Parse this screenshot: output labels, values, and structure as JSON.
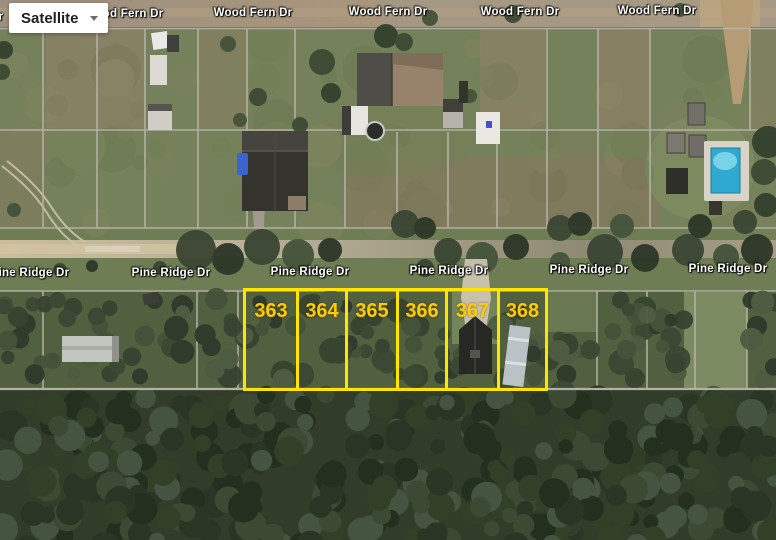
{
  "map_controls": {
    "type_button": {
      "label": "Satellite",
      "icon": "chevron-down-icon"
    }
  },
  "roads": {
    "wood_fern": {
      "name": "Wood Fern Dr"
    },
    "pine_ridge": {
      "name": "Pine Ridge Dr"
    }
  },
  "parcels": {
    "numbers": [
      "363",
      "364",
      "365",
      "366",
      "367",
      "368"
    ],
    "outline_color": "#FFE400",
    "number_color": "#FFCC00"
  },
  "colors": {
    "road_label_text": "#FFFFFF",
    "grid_line": "#B9B5AB",
    "pool_water": "#3AB5DC",
    "forest_green": "#2F3A29",
    "field_green": "#75805A",
    "road_tan": "#C9BA99"
  }
}
